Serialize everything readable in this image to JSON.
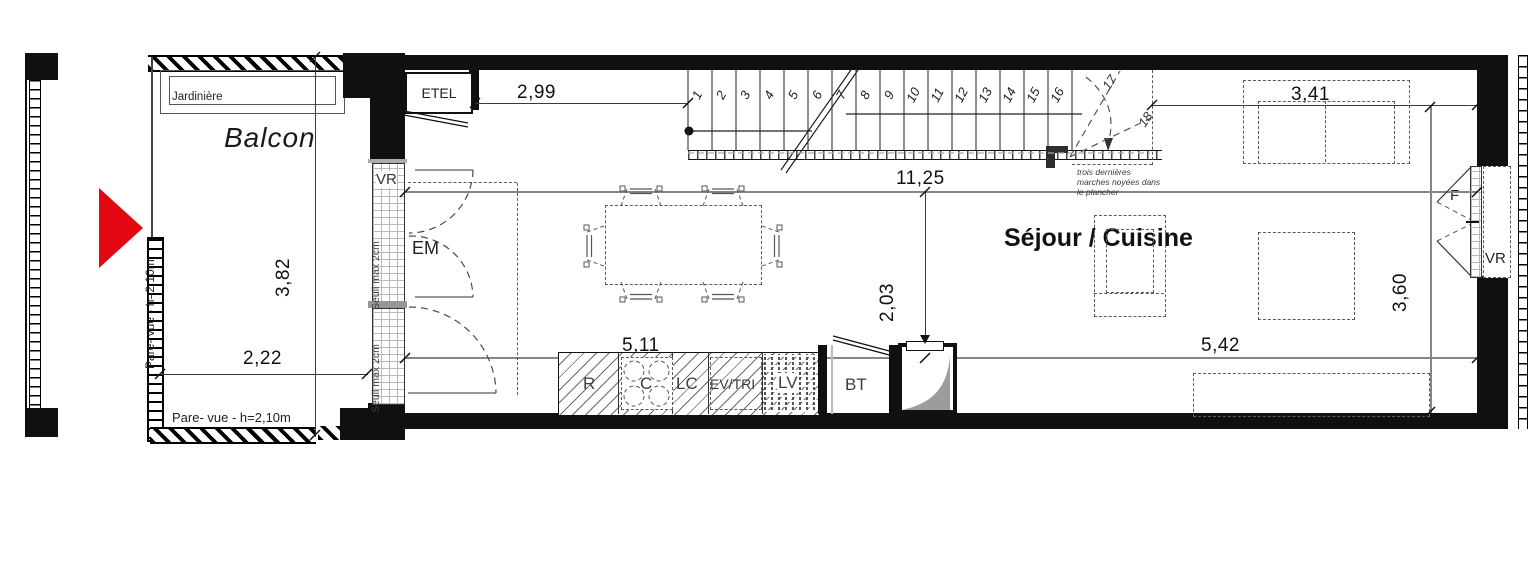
{
  "colors": {
    "accent_red": "#e30613",
    "wall": "#101010",
    "dim_gray": "#858585"
  },
  "balcony": {
    "label": "Balcon",
    "planter_label": "Jardinière",
    "privacy_screen_label": "Pare- vue - h=2,10m",
    "width": "2,22",
    "depth": "3,82"
  },
  "room": {
    "label": "Séjour / Cuisine",
    "entry_span": "2,99",
    "stair_to_wall": "3,41",
    "total_length": "11,25",
    "mid_height": "2,03",
    "left_span": "5,11",
    "right_span": "5,42",
    "right_depth": "3,60"
  },
  "openings": {
    "roller_shutter_label": "VR",
    "window_label": "F",
    "threshold_label": "Seuil max 2cm",
    "electrical_closet_label": "ETEL",
    "utility_space_label": "EM",
    "technical_box_label": "BT"
  },
  "kitchen": {
    "fridge": "R",
    "cooktop": "C",
    "counter": "LC",
    "sink": "EV/TRI",
    "dishwasher": "LV"
  },
  "stairs": {
    "numbers": [
      "1",
      "2",
      "3",
      "4",
      "5",
      "6",
      "7",
      "8",
      "9",
      "10",
      "11",
      "12",
      "13",
      "14",
      "15",
      "16",
      "17",
      "18"
    ],
    "note": [
      "trois dernières",
      "marches noyées dans",
      "le plancher"
    ]
  }
}
